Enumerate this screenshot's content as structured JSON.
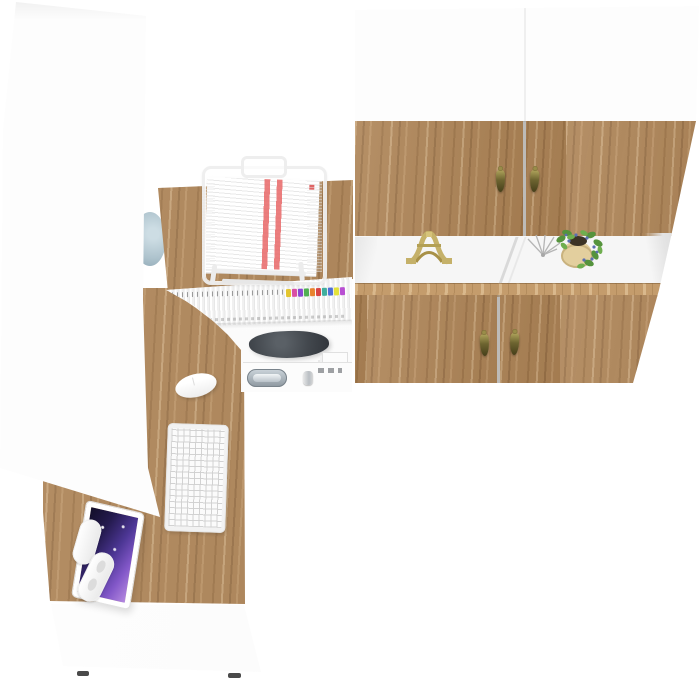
{
  "scene": {
    "title": "Home office furniture set — top view 3D render",
    "style": "white and oak",
    "background": "#ffffff"
  },
  "palette": {
    "wood": "#ad8355",
    "wood_light": "#c49c6c",
    "wood_dark": "#7a5731",
    "white_panel": "#fdfdfd",
    "panel_edge": "#e4e4e4",
    "handle_brass": "#877c3a",
    "door_gap": "#87837d",
    "screen_dark": "#120e28",
    "screen_purple": "#4c3694",
    "screen_violet": "#b68ae0",
    "plant_green": "#55933d",
    "plant_berries": "#5b6fb0",
    "pot_beige": "#e3cf9e",
    "figurine_gold": "#c5b169",
    "printer_gray": "#42474d",
    "chrome": "#a8b2ba",
    "disc_blue": "#aec3cd",
    "paper_highlight_red": "#e65a5a",
    "foot_dark": "#4a4a4a"
  },
  "objects": {
    "left_wardrobe": {
      "label": "Tall white wardrobe cabinet"
    },
    "right_cabinet": {
      "label": "Wall cabinet with four oak doors and open shelf",
      "door_count": 4,
      "handle_style": "brass teardrop pulls",
      "shelf_items": [
        "Eiffel Tower figurine",
        "silver wire ornament",
        "potted plant with blue berries"
      ]
    },
    "desk": {
      "label": "L-shaped oak desk with hutch"
    },
    "document_tray": {
      "label": "White wire document tray stacked with papers",
      "paper_highlight_stripes": 2
    },
    "magazine_shelf": {
      "label": "Hutch shelf with white file spines and colored index tabs"
    },
    "printer_nook": {
      "label": "Hutch compartment with dark printer and drawer"
    },
    "drawer_pull": {
      "label": "Chrome recessed drawer pull with side knob"
    },
    "monitor": {
      "label": "Monitor on white articulated arm, purple galaxy wallpaper"
    },
    "keyboard": {
      "label": "White compact keyboard"
    },
    "mouse": {
      "label": "White wireless mouse"
    },
    "drawer_base": {
      "label": "White desk pedestal with two dark feet",
      "feet": 2
    },
    "wall_disc": {
      "label": "Pale blue round decor partially hidden behind wardrobe"
    }
  },
  "magazine_tabs": {
    "colors": [
      "#e3c52e",
      "#d94fa4",
      "#8a46d2",
      "#4fae52",
      "#e8832e",
      "#d94444",
      "#3fae9e",
      "#4f6fd6",
      "#e3e23a",
      "#b84fd2"
    ]
  }
}
